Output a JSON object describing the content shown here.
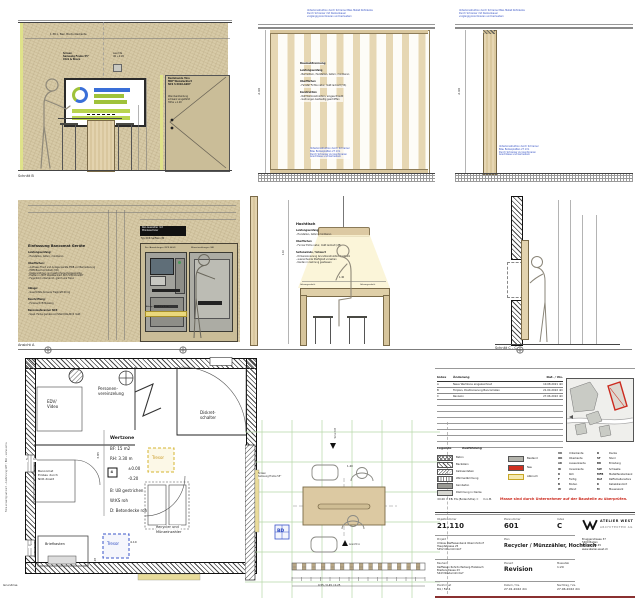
{
  "drawing": {
    "schnitt_b": {
      "label": "Schnitt B",
      "ceiling_dim": "1.38 ü. Bez. Bordunterkante",
      "screen_note": "Screen\nSamsung Frame 55\"\nClick & Share",
      "leuchte_note": "Leuchte\nUK +2.20",
      "door_note": "Bestehende Türe\nMDF Weisslackiert\nNCS S 6010-G90Y",
      "door_note2": "Wandverkleidung\nschwarz eingefärbt\nHöhe +1.20"
    },
    "lamellenwand": {
      "top_note": "Unterkonstruktion durch Schreiner Bzw. Metall Kühldecke\nDurch Schreiner mit Deckenbauer\nvorgängig koordinieren und bemustern",
      "title": "Raumabtrennung",
      "leistung_title": "Leistungsumfang",
      "leistung_line": "- Bemustern, Herstellen, liefern, montieren",
      "oberflaechen_title": "Oberflächen",
      "oberflaechen_line": "- Fenster Fichte natur, matt lackiert (VS)",
      "konstruktion_title": "Konstruktion",
      "konstruktion_lines": "- Rahmenkonstruktion, eingeschraubt\n- Gehrungen beidseitig geschliffen",
      "bottom_note": "Unterkonstruktion durch Schreiner\nBzw. Bodenplatten 27 mm\nDurch Schreiner zu koordinieren\nAnschlüsse und bemustern",
      "height_dim": "2.60"
    },
    "einzellamelle": {
      "top_note": "Unterkonstruktion durch Schreiner Bzw. Metall Kühldecke\nDurch Schreiner mit Deckenbauer\nvorgängig koordinieren und bemustern",
      "bottom_note": "Unterkonstruktion durch Schreiner\nBzw. Bodenplatten 27 mm\nDurch Schreiner zu koordinieren\nAnschlüsse und bemustern",
      "height_dim": "2.60"
    },
    "ansicht_a": {
      "label": "Ansicht A",
      "title": "Einfassung Bancomat Geräte",
      "leistung_title": "Leistungsumfang:",
      "leistung_line": "- Herstellen, liefern, montieren",
      "oberflaechen_title": "Oberflächen:",
      "oberflaechen_lines": "- Aufmass Front und Anlage Geräte EWB vor Bemusterung\n- EWB Bauchromstahl (CD)\n- Kastenrahmen und gestrichene Ruggenkante\n- Platten in MDF Weisslackiert NCS S 6010-G90Y\n- Fugenbild unterkannt, gleich wie Türen",
      "ablage_title": "Ablage:",
      "ablage_line": "- Geschlitzte Konsole Tragkraft 60 kg",
      "beschriftung_title": "Beschriftung:",
      "beschriftung_line": "- Folienschrift Messing",
      "scanner_title": "Bancomatscanner NCR",
      "scanner_line": "- Spez. Farbe gemäss Architekt RAL/NCS matt",
      "tag": "Rec-Auszahler mit\nMünzwechsler",
      "tag_sub": "Typ NCR SelfServ 84",
      "machine_left": "Rec./Auszahlungen (NCR 6634)",
      "machine_right": "Münzeinzahlungen (SB)",
      "shelf_note": "Ablage 60 x 1.5 x 5 cm"
    },
    "hochtisch": {
      "title": "Hochtisch",
      "leistung_title": "Leistungsumfang",
      "leistung_line": "- Herstellen, liefern, montieren",
      "oberflaechen_title": "Oberflächen",
      "oberflaechen_line": "- Furnier Eiche natur, matt lackiert (2B)",
      "seiten_title": "Seitenwände / Schwert",
      "seiten_lines": "- Dimensionierung Grundkonstruktion Kantholz\n- ausreichende Steifigkeit vorsehen\n- Kanten in Gehrung gestossen",
      "gehrung_left": "Gehrungsschnitt",
      "gehrung_right": "Gehrungsschnitt",
      "width_dim": "1.40",
      "height_dim": "1.10"
    },
    "schnitt_c": {
      "label": "Schnitt C - C"
    },
    "grundriss": {
      "label": "Grundriss",
      "room_edv": "EDV/\nVideo",
      "room_pv": "Personen-\nvereinzelung",
      "room_diskret": "Diskret-\nschalter",
      "wertzone_title": "Wertzone",
      "wertzone_bf": "BF: 15 m2",
      "wertzone_rh": "RH: 3.30 m",
      "level_high": "±0.00",
      "level_low": "-0.20",
      "finish_b": "B: UB gestrichen",
      "finish_w": "W:KS roh",
      "finish_d": "D: Betondecke roh",
      "bancomat_note": "Bancomat\nEinbau durch\nNCR direkt",
      "briefkasten": "Briefkasten",
      "tresor_blue": "Tresor",
      "tresor_yellow": "Tresor",
      "recycler": "Recycler und\nMünzeinzahler",
      "dim_410": "4.10",
      "dim_385": "3.85",
      "dim_218": "2.18",
      "tag_4": "4",
      "tag_2": "2",
      "tag_15": "15",
      "tag_17l": "17",
      "tag_17r": "17",
      "tag_16": "16",
      "side_note": "Folie einseitig satiniert – Ausführung GHF / BLR – siehe extra"
    },
    "detail": {
      "bd": "BD",
      "screen_note": "Screen\nSamsung Frame 55\"",
      "marker_top": "Schnitt B",
      "marker_bottom": "Ansicht A",
      "dim_140": "1.40",
      "dim_string": "0.55 / 0.45 / 0.25"
    }
  },
  "titleblock": {
    "index_header": {
      "index": "Index",
      "aenderung": "Änderung",
      "dat": "Dat. / Vis."
    },
    "index_rows": [
      {
        "idx": "A",
        "text": "Neue Wertzone eingezeichnet",
        "dat": "10.08.2021 dm"
      },
      {
        "idx": "B",
        "text": "Türplan, Positionierung Bancomaten",
        "dat": "21.04.2022 dm"
      },
      {
        "idx": "C",
        "text": "Revision",
        "dat": "27.06.2022 dm"
      }
    ],
    "legend_title": "Legende",
    "legend_sub": "Ausführung",
    "materials": [
      "Beton",
      "Backstein",
      "Kalksandstein",
      "Wärmedämmung",
      "Kernbeton",
      "Dämmung in Decke"
    ],
    "states": [
      "Bestand",
      "Neu",
      "Abbruch"
    ],
    "abbrev_left": [
      [
        "UK",
        "Unterkante"
      ],
      [
        "OK",
        "Oberkante"
      ],
      [
        "AK",
        "Aussenkante"
      ],
      [
        "IK",
        "Innenkante"
      ],
      [
        "R",
        "Roh"
      ],
      [
        "F",
        "Fertig"
      ],
      [
        "B",
        "Boden"
      ],
      [
        "W",
        "Wand"
      ]
    ],
    "abbrev_right": [
      [
        "D",
        "Decke"
      ],
      [
        "ST",
        "Sturz"
      ],
      [
        "BR",
        "Brüstung"
      ],
      [
        "SW",
        "Schwelle"
      ],
      [
        "MFB",
        "Metallfensterbank"
      ],
      [
        "Raf",
        "Raffamellenstore"
      ],
      [
        "K",
        "Kabelstandort"
      ],
      [
        "M",
        "Mauerwerk"
      ]
    ],
    "datum_note": "±0.00 = P.B. EG (Bodenhöhe) =",
    "datum_unit": "m ü.M.",
    "red_note": "Masse sind durch Unternehmer auf der Baustelle zu überprüfen.",
    "objekt_label": "Objektnummer",
    "objekt_value": "21.110",
    "plannr_label": "Plannummer",
    "plannr_value": "601",
    "index_label": "Index",
    "index_value": "C",
    "projekt_label": "Projekt",
    "projekt_value": "Umbau Raiffeisenbank Oberrohrdorf\nHauptstrasse 25\n5452 Oberrohrdorf",
    "plan_label": "Plan",
    "plan_value": "Recycler / Münzzähler, Hochtisch",
    "bauherr_label": "Bauherr",
    "bauherr_value": "Raiffeisen Rohrdorferberg-Fislisbach\nBreitenstrasse 23\n5443 Niederrohrdorf",
    "planart_label": "Planart",
    "planart_value": "Revision",
    "massstab_label": "Massstab",
    "massstab_value": "1:20",
    "format_label": "Planformat",
    "format_value": "84 / 59.4",
    "datum_label": "Datum / Vis.",
    "datum_value": "27.01.2022  dm",
    "nachtrag_label": "Nachtrag / Vis.",
    "nachtrag_value": "27.06.2022  dm",
    "logo_name": "ATELIER WEST",
    "logo_sub": "ARCHITEKTEN AG",
    "address": "Bruggerstrasse 37\n5400 Baden\n056 204 45 45\nwww.atelier-west.ch"
  }
}
